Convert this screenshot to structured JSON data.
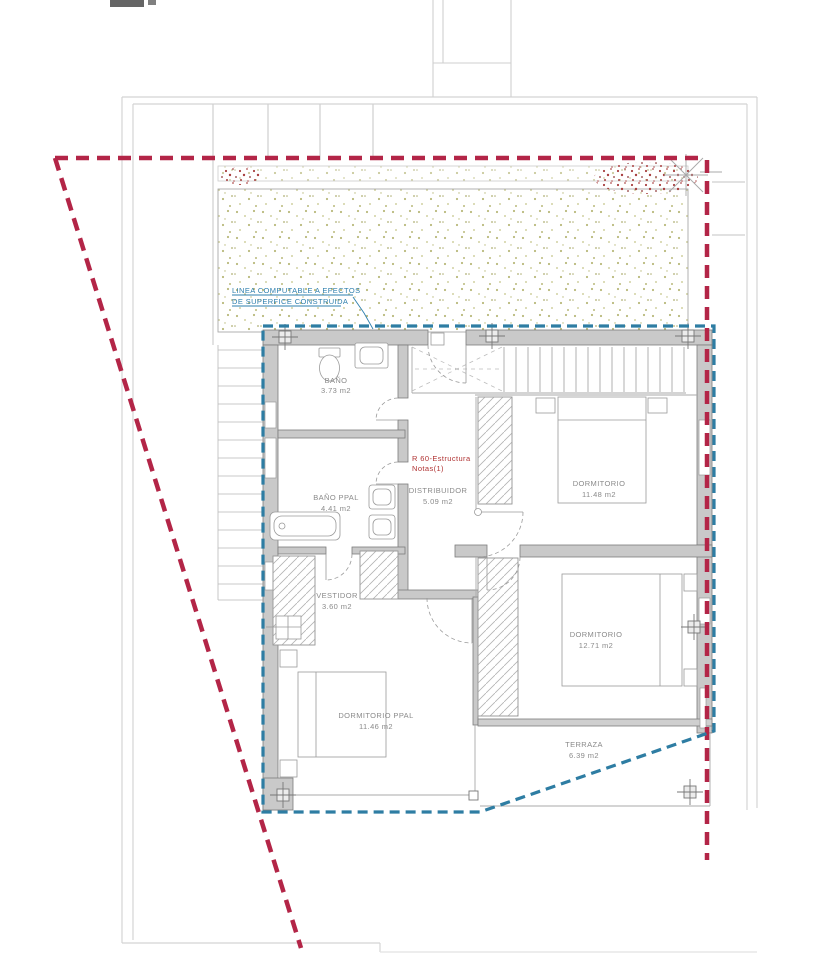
{
  "drawing": {
    "title": "Planta piso - vivienda",
    "annotations": {
      "boundary_note_line1": "LINEA COMPUTABLE A EFECTOS",
      "boundary_note_line2": "DE SUPERFICE CONSTRUIDA",
      "structure_note_line1": "R 60-Estructura",
      "structure_note_line2": "Notas(1)"
    },
    "rooms": [
      {
        "name": "BAÑO",
        "area": "3.73 m2"
      },
      {
        "name": "BAÑO PPAL",
        "area": "4.41 m2"
      },
      {
        "name": "VESTIDOR",
        "area": "3.60 m2"
      },
      {
        "name": "DISTRIBUIDOR",
        "area": "5.09 m2"
      },
      {
        "name": "DORMITORIO",
        "area": "11.48 m2"
      },
      {
        "name": "DORMITORIO",
        "area": "12.71 m2"
      },
      {
        "name": "DORMITORIO PPAL",
        "area": "11.46 m2"
      },
      {
        "name": "TERRAZA",
        "area": "6.39 m2"
      }
    ],
    "colors": {
      "property_line": "#b32547",
      "computable_line": "#2e7da3",
      "wall_fill": "#c9c9c9",
      "terrain_dot": "#b9b97b",
      "shrub_dot": "#a84040",
      "note_red": "#b03333",
      "note_blue": "#2e7fae"
    }
  }
}
